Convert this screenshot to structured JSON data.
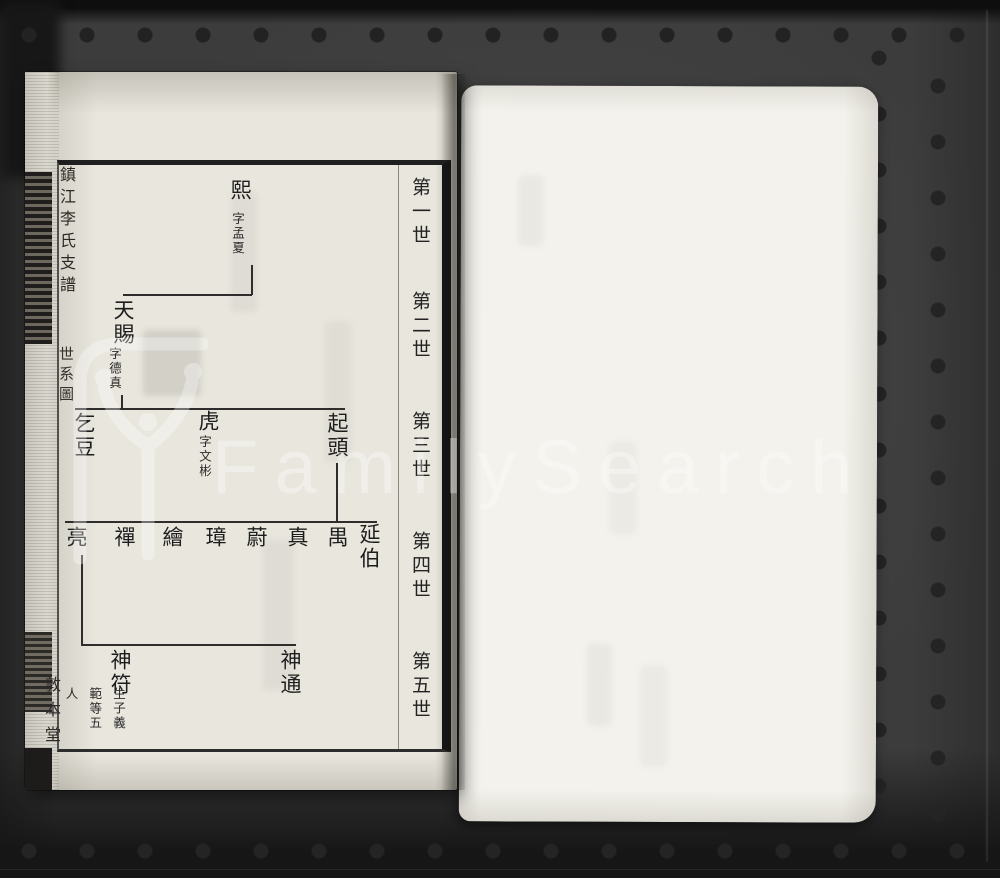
{
  "watermark": {
    "brand": "FamilySearch"
  },
  "spine": {
    "title": "鎮江李氏支譜",
    "section": "世系圖",
    "hall": "敦本堂"
  },
  "chart": {
    "generation_labels": [
      "第一世",
      "第二世",
      "第三世",
      "第四世",
      "第五世"
    ],
    "generation1": {
      "name": "熙",
      "courtesy_note": "字孟夏"
    },
    "generation2": {
      "name": "天賜",
      "courtesy_note": "字德真"
    },
    "generation3": {
      "son_right": "起頭",
      "son_middle": "虎",
      "son_middle_courtesy": "字文彬",
      "son_left": "乞豆"
    },
    "generation4": {
      "names_right_to_left": [
        "延伯",
        "禺",
        "真",
        "蔚",
        "璋",
        "繪",
        "禪",
        "亮"
      ]
    },
    "generation5": {
      "son_right": "神通",
      "son_left": "神符",
      "son_left_note": "生子義範等五人"
    }
  }
}
